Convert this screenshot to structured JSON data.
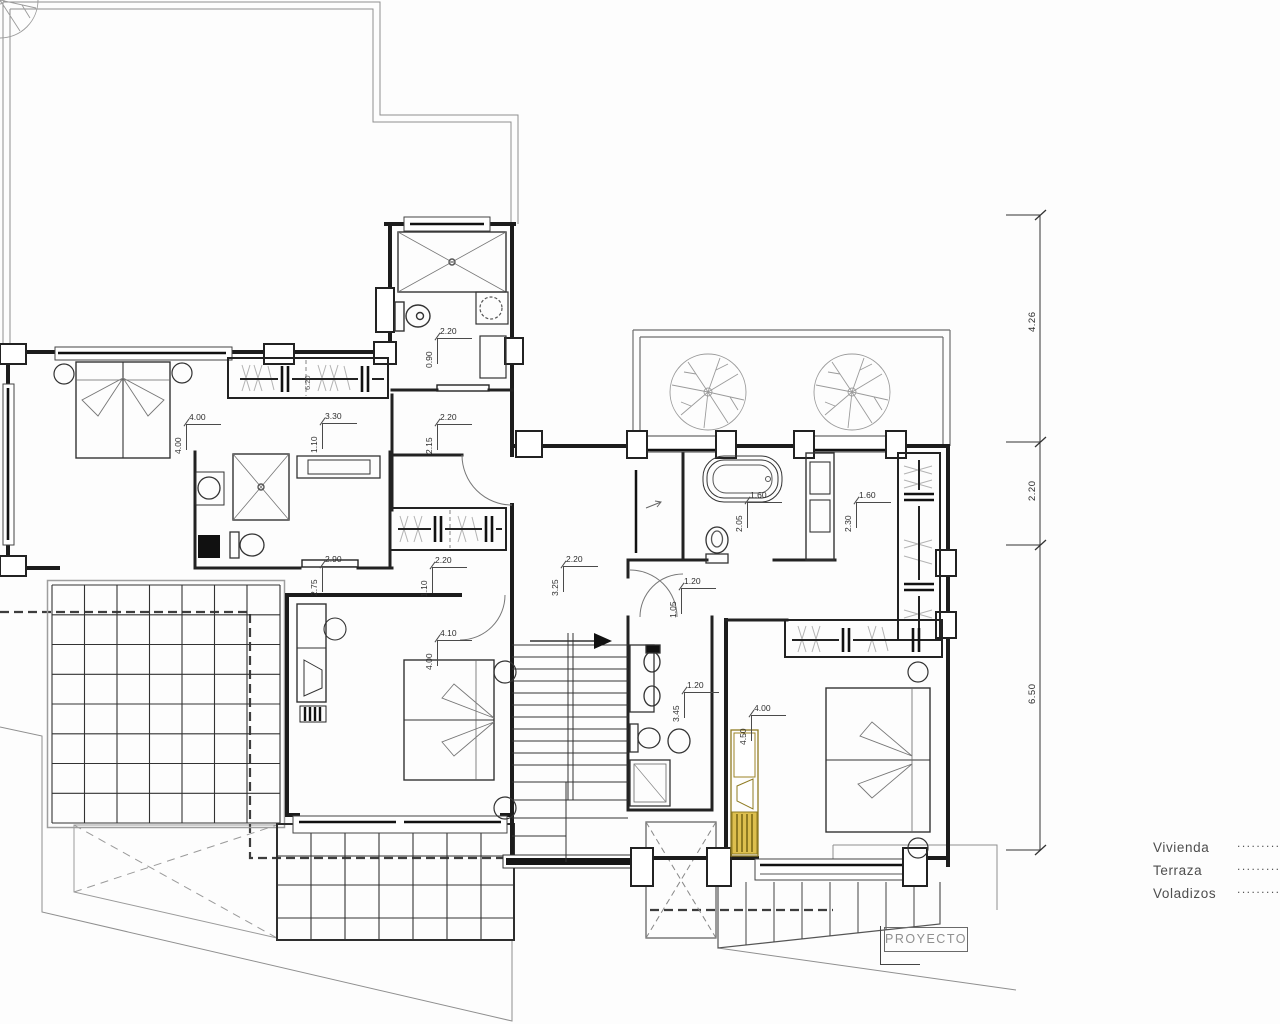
{
  "title_block": {
    "label": "PROYECTO"
  },
  "legend": {
    "items": [
      {
        "label": "Vivienda",
        "dots": "............"
      },
      {
        "label": "Terraza",
        "dots": "............"
      },
      {
        "label": "Voladizos",
        "dots": "............"
      }
    ]
  },
  "dimension_chain_right": {
    "values": [
      {
        "value": "4.26",
        "y": 318
      },
      {
        "value": "2.20",
        "y": 487
      },
      {
        "value": "6.50",
        "y": 690
      }
    ]
  },
  "dimensions": [
    {
      "h": "2.20",
      "v": "0.90",
      "x": 437,
      "y": 338
    },
    {
      "h": "2.20",
      "v": "2.15",
      "x": 437,
      "y": 424
    },
    {
      "h": "4.00",
      "v": "4.00",
      "x": 186,
      "y": 424
    },
    {
      "h": "3.30",
      "v": "1.10",
      "x": 322,
      "y": 423
    },
    {
      "h": "2.90",
      "v": "2.75",
      "x": 322,
      "y": 566
    },
    {
      "h": "2.20",
      "v": "1.10",
      "x": 432,
      "y": 567
    },
    {
      "h": "2.20",
      "v": "3.25",
      "x": 563,
      "y": 566
    },
    {
      "h": "1.60",
      "v": "2.05",
      "x": 747,
      "y": 502
    },
    {
      "h": "1.60",
      "v": "2.30",
      "x": 856,
      "y": 502
    },
    {
      "h": "1.20",
      "v": "1.05",
      "x": 681,
      "y": 588
    },
    {
      "h": "4.10",
      "v": "4.00",
      "x": 437,
      "y": 640
    },
    {
      "h": "1.20",
      "v": "3.45",
      "x": 684,
      "y": 692
    },
    {
      "h": "4.00",
      "v": "4.50",
      "x": 751,
      "y": 715
    }
  ],
  "inline_labels": [
    {
      "value": "6.20",
      "x": 303,
      "y": 390
    }
  ],
  "colors": {
    "wall": "#1c1c1c",
    "thin_line": "#8f8f8f",
    "hatch": "#b3b3b3",
    "highlight_yellow": "#ddbf4e",
    "highlight_yellow_dark": "#8f7b22"
  }
}
